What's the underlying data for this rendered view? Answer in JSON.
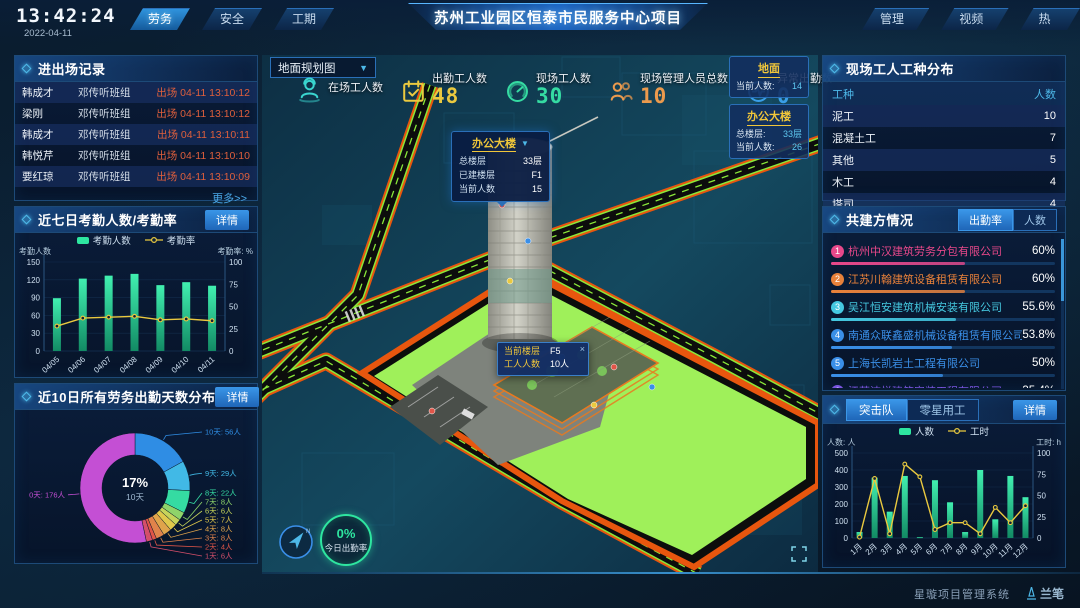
{
  "header": {
    "time": "13:42:24",
    "date": "2022-04-11",
    "title": "苏州工业园区恒泰市民服务中心项目",
    "tabs_left": [
      {
        "label": "劳务",
        "active": true
      },
      {
        "label": "安全",
        "active": false
      },
      {
        "label": "工期",
        "active": false
      }
    ],
    "tabs_right": [
      {
        "label": "管理行为",
        "active": false
      },
      {
        "label": "视频监控",
        "active": false
      },
      {
        "label": "热力图",
        "active": false
      }
    ]
  },
  "left": {
    "records": {
      "title": "进出场记录",
      "rows": [
        {
          "name": "韩成才",
          "group": "邓传听班组",
          "event": "出场 04-11 13:10:12"
        },
        {
          "name": "梁刚",
          "group": "邓传听班组",
          "event": "出场 04-11 13:10:12"
        },
        {
          "name": "韩成才",
          "group": "邓传听班组",
          "event": "出场 04-11 13:10:11"
        },
        {
          "name": "韩悦芹",
          "group": "邓传听班组",
          "event": "出场 04-11 13:10:10"
        },
        {
          "name": "要红琼",
          "group": "邓传听班组",
          "event": "出场 04-11 13:10:09"
        }
      ],
      "more": "更多>>"
    },
    "attendance": {
      "title": "近七日考勤人数/考勤率",
      "detail": "详情"
    },
    "distribution": {
      "title": "近10日所有劳务出勤天数分布",
      "detail": "详情"
    }
  },
  "center": {
    "map_select": "地面规划图",
    "stats": [
      {
        "label": "在场工人数",
        "value": "",
        "icon": "worker-icon",
        "color": "#3ad6d0"
      },
      {
        "label": "出勤工人数",
        "value": "48",
        "icon": "calendar-check-icon",
        "color": "#eac93f"
      },
      {
        "label": "现场工人数",
        "value": "30",
        "icon": "gauge-icon",
        "color": "#35dba2"
      },
      {
        "label": "现场管理人员总数",
        "value": "10",
        "icon": "people-icon",
        "color": "#eb9a4d"
      },
      {
        "label": "异常出勤数",
        "value": "0",
        "icon": "pulse-icon",
        "color": "#3a9fe8"
      }
    ],
    "badges": [
      {
        "title": "地面",
        "rows": [
          {
            "label": "当前人数:",
            "value": "14"
          }
        ]
      },
      {
        "title": "办公大楼",
        "rows": [
          {
            "label": "总楼层:",
            "value": "33层"
          },
          {
            "label": "当前人数:",
            "value": "26"
          }
        ]
      }
    ],
    "building_popup": {
      "title": "办公大楼",
      "rows": [
        {
          "label": "总楼层",
          "value": "33层"
        },
        {
          "label": "已建楼层",
          "value": "F1"
        },
        {
          "label": "当前人数",
          "value": "15"
        }
      ]
    },
    "floor_tooltip": {
      "close": "×",
      "rows": [
        {
          "label": "当前楼层",
          "value": "F5"
        },
        {
          "label": "工人人数",
          "value": "10人"
        }
      ]
    },
    "gauge": {
      "value": "0%",
      "label": "今日出勤率"
    }
  },
  "right": {
    "trades": {
      "title": "现场工人工种分布",
      "headers": [
        "工种",
        "人数"
      ],
      "rows": [
        {
          "name": "泥工",
          "count": "10"
        },
        {
          "name": "混凝土工",
          "count": "7"
        },
        {
          "name": "其他",
          "count": "5"
        },
        {
          "name": "木工",
          "count": "4"
        },
        {
          "name": "塔司",
          "count": "4"
        }
      ]
    },
    "partners": {
      "title": "共建方情况",
      "tabs": [
        {
          "label": "出勤率",
          "active": true
        },
        {
          "label": "人数",
          "active": false
        }
      ],
      "items": [
        {
          "rank": "1",
          "name": "杭州中汉建筑劳务分包有限公司",
          "pct": "60%",
          "value": 60,
          "color": "#e8488a"
        },
        {
          "rank": "2",
          "name": "江苏川翰建筑设备租赁有限公司",
          "pct": "60%",
          "value": 60,
          "color": "#e8813a"
        },
        {
          "rank": "3",
          "name": "吴江恒安建筑机械安装有限公司",
          "pct": "55.6%",
          "value": 55.6,
          "color": "#45c8e0"
        },
        {
          "rank": "4",
          "name": "南通众联鑫盛机械设备租赁有限公司",
          "pct": "53.8%",
          "value": 53.8,
          "color": "#3a8fe8"
        },
        {
          "rank": "5",
          "name": "上海长凯岩土工程有限公司",
          "pct": "50%",
          "value": 50,
          "color": "#3a8fe8"
        },
        {
          "rank": "6",
          "name": "江苏洁悦建筑安装工程有限公司",
          "pct": "35.4%",
          "value": 35.4,
          "color": "#7a55e0"
        }
      ]
    },
    "teams": {
      "tabs": [
        {
          "label": "突击队",
          "active": true
        },
        {
          "label": "零星用工",
          "active": false
        }
      ],
      "detail": "详情"
    }
  },
  "footer": {
    "system": "星璇项目管理系统",
    "logo": "兰笔"
  },
  "chart_data": {
    "attendance": {
      "type": "bar+line",
      "title": "近七日考勤人数/考勤率",
      "categories": [
        "04/05",
        "04/06",
        "04/07",
        "04/08",
        "04/09",
        "04/10",
        "04/11"
      ],
      "series": [
        {
          "name": "考勤人数",
          "type": "bar",
          "axis": "left",
          "color": "#2ee6a0",
          "values": [
            89,
            122,
            127,
            130,
            111,
            116,
            110
          ]
        },
        {
          "name": "考勤率",
          "type": "line",
          "axis": "right",
          "color": "#eac93f",
          "values": [
            28,
            37,
            38,
            39,
            35,
            36,
            34
          ]
        }
      ],
      "ylabel_left": "考勤人数",
      "ylabel_right": "考勤率: %",
      "ylim_left": [
        0,
        150
      ],
      "ylim_right": [
        0,
        100
      ],
      "yticks_left": [
        0,
        30,
        60,
        90,
        120,
        150
      ],
      "yticks_right": [
        0,
        25,
        50,
        75,
        100
      ],
      "legend_position": "top",
      "grid": true
    },
    "distribution": {
      "type": "pie",
      "title": "近10日所有劳务出勤天数分布",
      "slices": [
        {
          "label": "10天",
          "count": "56人",
          "value": 56,
          "color": "#2f8de4"
        },
        {
          "label": "9天",
          "count": "29人",
          "value": 29,
          "color": "#41b9e6"
        },
        {
          "label": "8天",
          "count": "22人",
          "value": 22,
          "color": "#35dba2"
        },
        {
          "label": "7天",
          "count": "8人",
          "value": 8,
          "color": "#8fd46a"
        },
        {
          "label": "6天",
          "count": "6人",
          "value": 6,
          "color": "#c6d45a"
        },
        {
          "label": "5天",
          "count": "7人",
          "value": 7,
          "color": "#e0c84b"
        },
        {
          "label": "4天",
          "count": "8人",
          "value": 8,
          "color": "#e0a44b"
        },
        {
          "label": "3天",
          "count": "8人",
          "value": 8,
          "color": "#e0834b"
        },
        {
          "label": "2天",
          "count": "4人",
          "value": 4,
          "color": "#e05548"
        },
        {
          "label": "1天",
          "count": "6人",
          "value": 6,
          "color": "#d44f6a"
        },
        {
          "label": "0天",
          "count": "176人",
          "value": 176,
          "color": "#c44fd4"
        }
      ],
      "center": {
        "pct": "17%",
        "label": "10天"
      }
    },
    "teams": {
      "type": "bar+line",
      "title": "突击队",
      "categories": [
        "1月",
        "2月",
        "3月",
        "4月",
        "5月",
        "6月",
        "7月",
        "8月",
        "9月",
        "10月",
        "11月",
        "12月"
      ],
      "series": [
        {
          "name": "人数",
          "type": "bar",
          "axis": "left",
          "color": "#2ee6a0",
          "values": [
            35,
            355,
            155,
            365,
            5,
            340,
            210,
            35,
            400,
            110,
            365,
            240
          ]
        },
        {
          "name": "工时",
          "type": "line",
          "axis": "right",
          "color": "#eac93f",
          "values": [
            1,
            70,
            5,
            87,
            72,
            10,
            18,
            18,
            5,
            36,
            18,
            38
          ]
        }
      ],
      "ylabel_left": "人数: 人",
      "ylabel_right": "工时: h",
      "ylim_left": [
        0,
        500
      ],
      "ylim_right": [
        0,
        100
      ],
      "yticks_left": [
        0,
        100,
        200,
        300,
        400,
        500
      ],
      "yticks_right": [
        0,
        25,
        50,
        75,
        100
      ],
      "legend_position": "top",
      "grid": true
    }
  }
}
